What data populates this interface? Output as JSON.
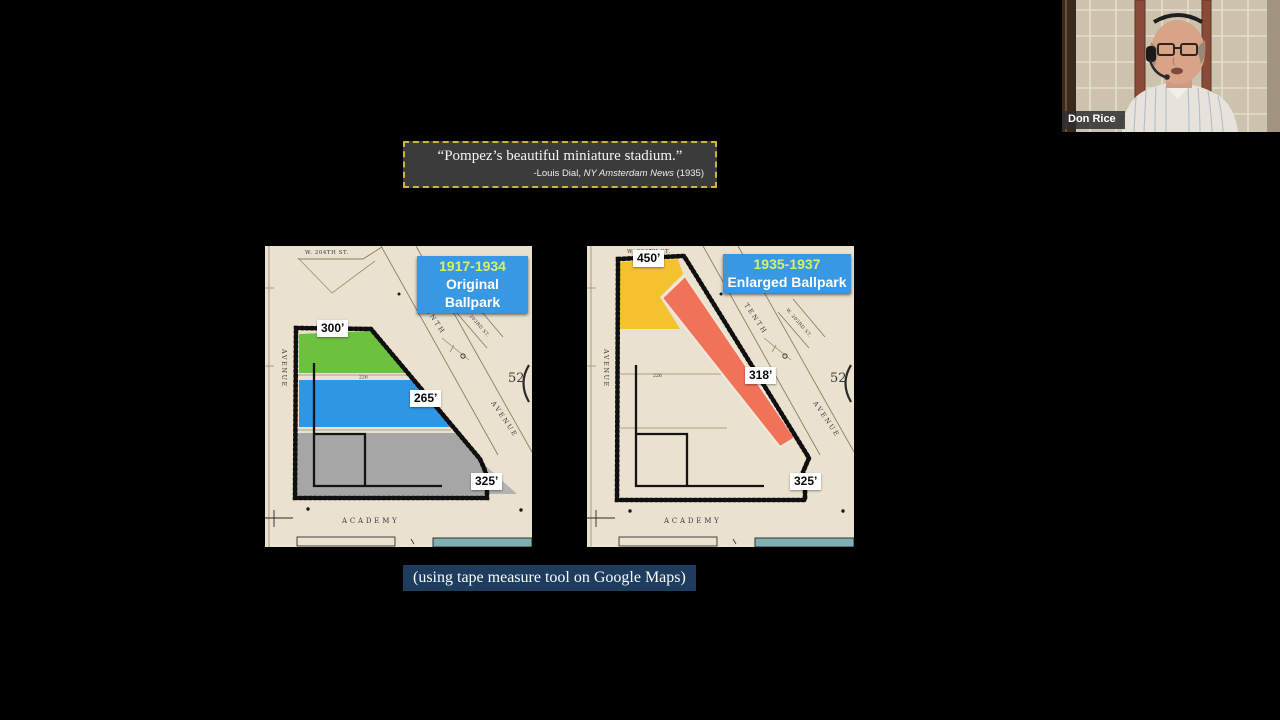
{
  "slide": {
    "quote": {
      "text": "“Pompez’s beautiful miniature stadium.”",
      "attribution_prefix": "-Louis Dial, ",
      "attribution_source": "NY Amsterdam News",
      "attribution_suffix": " (1935)"
    },
    "caption": "(using tape measure tool on Google Maps)"
  },
  "maps": {
    "streets": {
      "w204": "W. 204TH ST.",
      "tenth": "TENTH",
      "w203": "W. 203RD ST.",
      "avenue": "AVENUE",
      "academy": "ACADEMY",
      "block_number": "52",
      "lot_dimension": "226"
    },
    "left": {
      "title_line1": "1917-1934",
      "title_line2": "Original Ballpark",
      "left_field": "300’",
      "center_field": "265’",
      "right_field": "325’"
    },
    "right": {
      "title_line1": "1935-1937",
      "title_line2": "Enlarged Ballpark",
      "left_field": "450’",
      "center_field": "318’",
      "right_field": "325’"
    }
  },
  "webcam": {
    "participant_name": "Don Rice"
  },
  "colors": {
    "map_paper": "#eae1cf",
    "title_bg": "#3898e3",
    "title_year": "#d9ef67",
    "green_area": "#6cc13e",
    "blue_area": "#2f96e4",
    "gray_area": "#a6a6a6",
    "yellow_area": "#f4c22f",
    "red_strip": "#f07258",
    "quote_bg": "#3b3b3b",
    "quote_border": "#cfb23f",
    "caption_bg": "#1e3c5e",
    "teal_bar": "#7fb0b4"
  }
}
